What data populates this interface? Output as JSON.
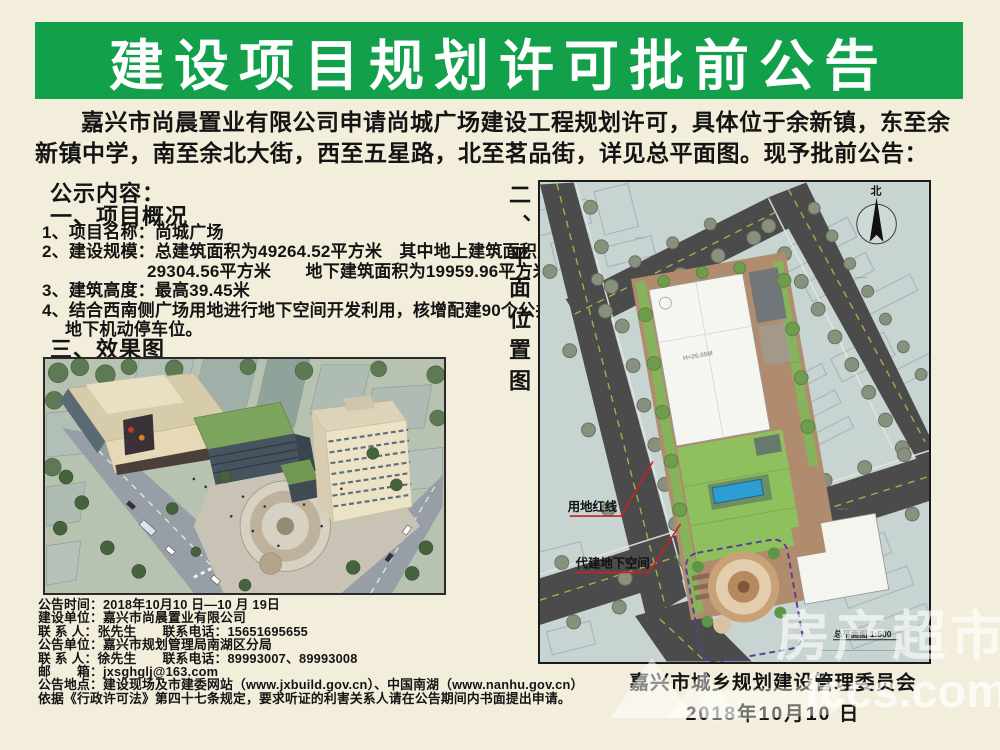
{
  "banner": {
    "title": "建设项目规划许可批前公告"
  },
  "intro": "嘉兴市尚晨置业有限公司申请尚城广场建设工程规划许可，具体位于余新镇，东至余新镇中学，南至余北大街，西至五星路，北至茗品街，详见总平面图。现予批前公告：",
  "content": {
    "heading": "公示内容：",
    "section1_title": "一、项目概况",
    "lines": [
      "1、项目名称：尚城广场",
      "2、建设规模：总建筑面积为49264.52平方米　其中地上建筑面积为",
      "29304.56平方米　　地下建筑面积为19959.96平方米",
      "3、建筑高度：最高39.45米",
      "4、结合西南侧广场用地进行地下空间开发利用，核增配建90个公共",
      "地下机动停车位。"
    ],
    "section3_title": "三、效果图",
    "section2_vertical_title": "二、平面位置图"
  },
  "site_plan": {
    "north_label": "北",
    "red_line_label": "用地红线",
    "underground_label": "代建地下空间",
    "building_height_label": "H=26.05M",
    "scale_label": "总平面图 1:500"
  },
  "footer": {
    "lines": [
      "公告时间：2018年10月10 日—10 月 19日",
      "建设单位：嘉兴市尚晨置业有限公司",
      "联 系 人：张先生　　联系电话：15651695655",
      "公告单位：嘉兴市规划管理局南湖区分局",
      "联 系 人：徐先生　　联系电话：89993007、89993008",
      "邮　　箱：jxsghglj@163.com",
      "公告地点：建设现场及市建委网站（www.jxbuild.gov.cn）、中国南湖（www.nanhu.gov.cn）",
      "依据《行政许可法》第四十七条规定，要求听证的利害关系人请在公告期间内书面提出申请。"
    ]
  },
  "signature": {
    "org": "嘉兴市城乡规划建设管理委员会",
    "date": "2018年10月10 日"
  },
  "watermark": {
    "text_cn": "房产超市",
    "text_en": "fccs.com"
  },
  "colors": {
    "banner_green": "#12a04b",
    "page_bg": "#f3eedb",
    "map_bg": "#c7d4d2",
    "red_leader_line": "#c92222",
    "purple_boundary": "#5b3e96"
  }
}
